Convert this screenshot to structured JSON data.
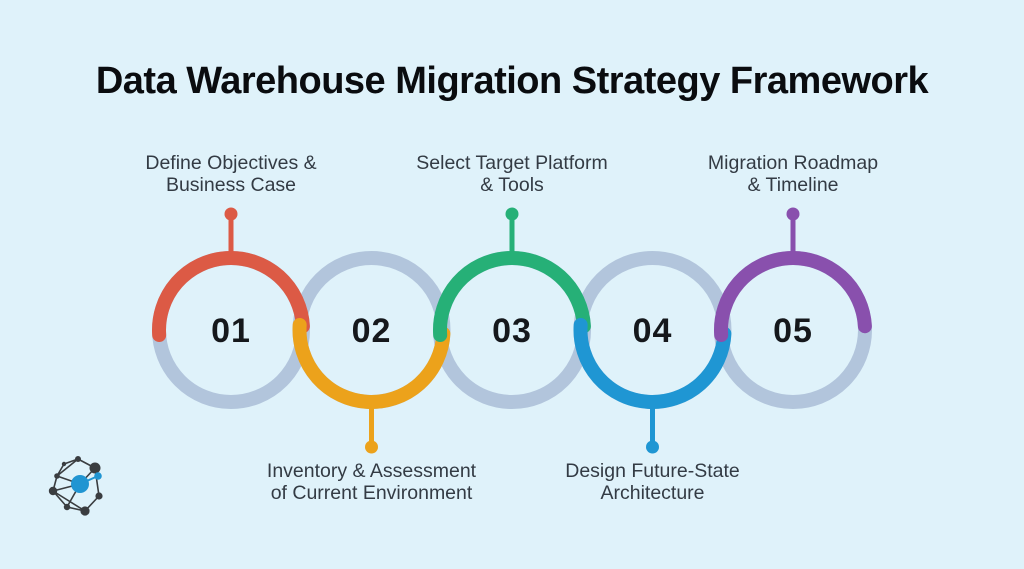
{
  "title": "Data Warehouse Migration Strategy Framework",
  "colors": {
    "background": "#dff2fa",
    "ring": "#b2c5dc",
    "number": "#15181c",
    "label_text": "#333b44",
    "title_text": "#0a0c0f"
  },
  "steps": [
    {
      "number": "01",
      "label_lines": [
        "Define Objectives &",
        "Business Case"
      ],
      "color": "#dc5a45",
      "label_position": "top"
    },
    {
      "number": "02",
      "label_lines": [
        "Inventory & Assessment",
        "of Current Environment"
      ],
      "color": "#eca21b",
      "label_position": "bottom"
    },
    {
      "number": "03",
      "label_lines": [
        "Select Target Platform",
        "& Tools"
      ],
      "color": "#26b077",
      "label_position": "top"
    },
    {
      "number": "04",
      "label_lines": [
        "Design Future-State",
        "Architecture"
      ],
      "color": "#1f96d3",
      "label_position": "bottom"
    },
    {
      "number": "05",
      "label_lines": [
        "Migration Roadmap",
        "& Timeline"
      ],
      "color": "#8950ad",
      "label_position": "top"
    }
  ],
  "logo": {
    "icon": "network-graph-logo",
    "node_color": "#3a3d40",
    "accent_color": "#2095d2"
  }
}
